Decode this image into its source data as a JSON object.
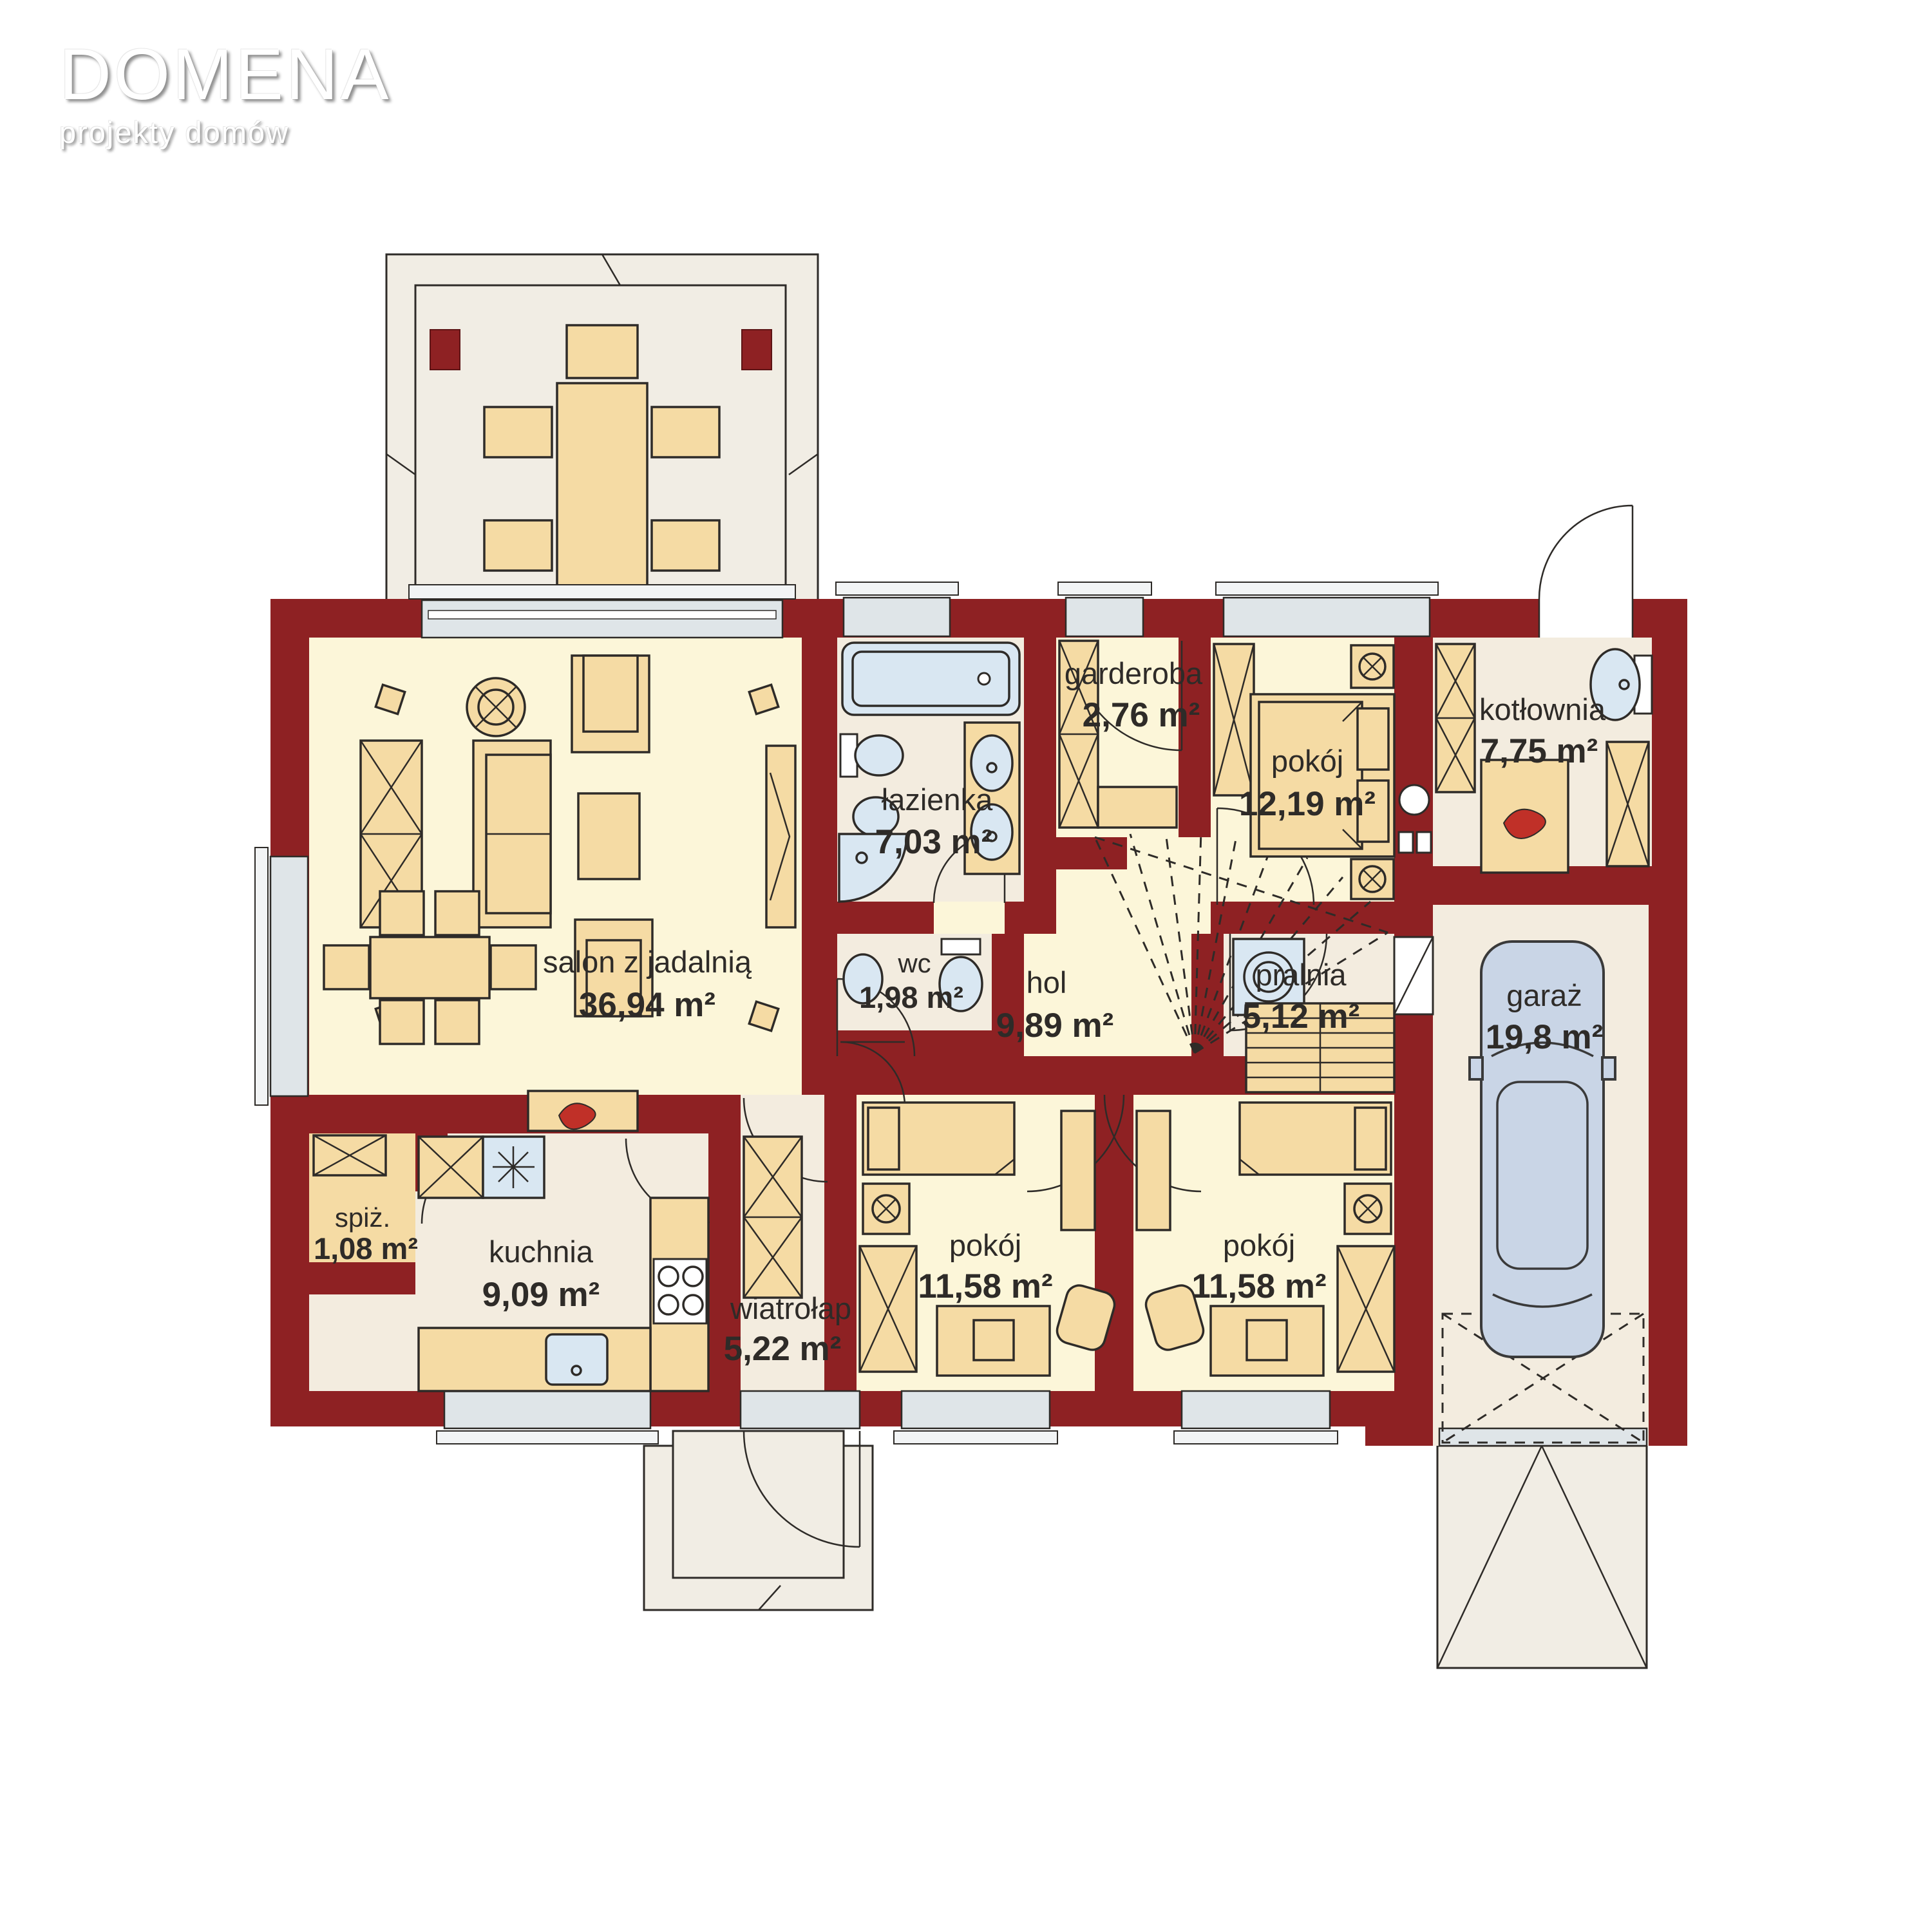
{
  "logo": {
    "title": "DOMENA",
    "subtitle": "projekty domów"
  },
  "plan_title": "rzut parteru",
  "rooms": [
    {
      "id": "salon",
      "label": "salon z jadalnią",
      "area": "36,94 m²"
    },
    {
      "id": "kuchnia",
      "label": "kuchnia",
      "area": "9,09 m²"
    },
    {
      "id": "spiz",
      "label": "spiż.",
      "area": "1,08 m²"
    },
    {
      "id": "wiatrolap",
      "label": "wiatrołap",
      "area": "5,22 m²"
    },
    {
      "id": "pokoj-1",
      "label": "pokój",
      "area": "11,58 m²"
    },
    {
      "id": "pokoj-2",
      "label": "pokój",
      "area": "11,58 m²"
    },
    {
      "id": "hol",
      "label": "hol",
      "area": "9,89 m²"
    },
    {
      "id": "wc",
      "label": "wc",
      "area": "1,98 m²"
    },
    {
      "id": "lazienka",
      "label": "łazienka",
      "area": "7,03 m²"
    },
    {
      "id": "garderoba",
      "label": "garderoba",
      "area": "2,76 m²"
    },
    {
      "id": "pokoj-3",
      "label": "pokój",
      "area": "12,19 m²"
    },
    {
      "id": "pralnia",
      "label": "pralnia",
      "area": "5,12 m²"
    },
    {
      "id": "kotlownia",
      "label": "kotłownia",
      "area": "7,75 m²"
    },
    {
      "id": "garaz",
      "label": "garaż",
      "area": "19,8 m²"
    }
  ],
  "colors": {
    "wall": "#8E2123",
    "room_warm_floor": "#FCF6D9",
    "room_cool_floor": "#F3ECDF",
    "furniture": "#F5DBA4",
    "fixtures": "#D9E7F2",
    "windows": "#DFE5E8",
    "terrace": "#F1EDE4",
    "outline": "#2E2B28",
    "flame": "#C03028"
  }
}
